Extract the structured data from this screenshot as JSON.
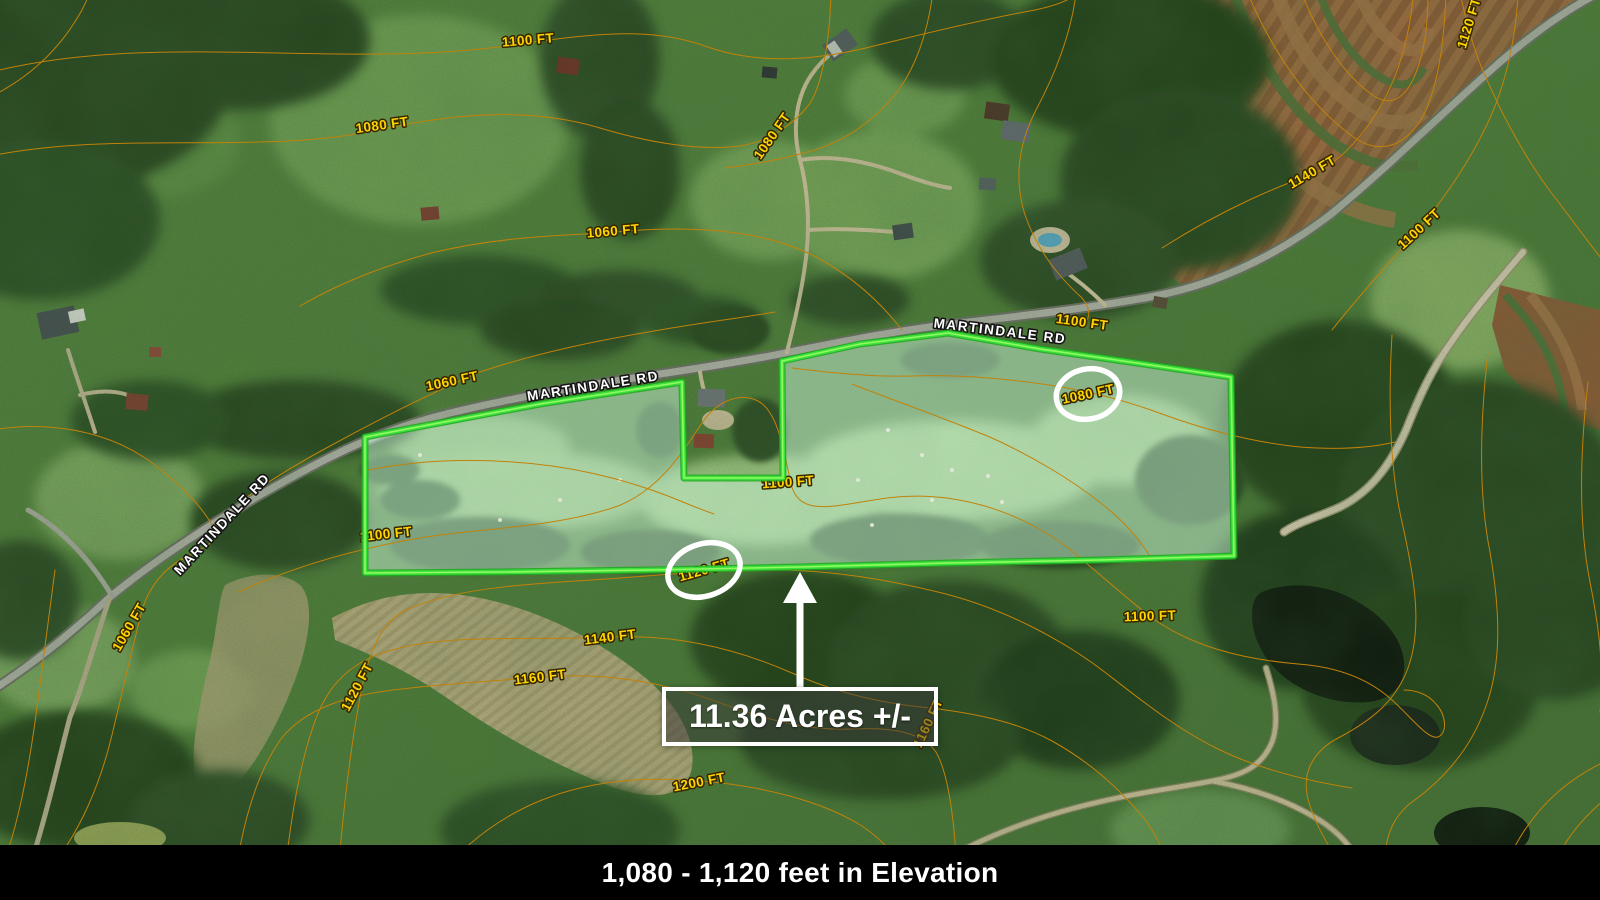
{
  "colors": {
    "contour_line": "#c28209",
    "contour_casing": "#7a4e00",
    "contour_label_fill": "#ffd400",
    "contour_label_outline": "#342700",
    "road_label_fill": "#ffffff",
    "road_label_outline": "#151515",
    "parcel_outline": "#3ae03a",
    "parcel_outline_glow": "#a9ff6e",
    "parcel_fill": "rgba(202,243,216,0.5)",
    "highlight_ellipse": "#ffffff",
    "arrow": "#ffffff",
    "callout_border": "#ffffff",
    "callout_bg": "rgba(58,58,58,0.52)",
    "callout_text": "#ffffff",
    "footer_bg": "#000000",
    "footer_text": "#ffffff"
  },
  "annotations": {
    "acreage_callout": {
      "text": "11.36 Acres +/-"
    },
    "footer": {
      "text": "1,080 - 1,120 feet in Elevation"
    },
    "road_labels": [
      {
        "text": "MARTINDALE RD",
        "x": 593,
        "y": 386,
        "rotation": -9
      },
      {
        "text": "MARTINDALE RD",
        "x": 1000,
        "y": 331,
        "rotation": 7
      },
      {
        "text": "MARTINDALE RD",
        "x": 222,
        "y": 524,
        "rotation": -47
      }
    ],
    "contour_labels": [
      {
        "text": "1100 FT",
        "x": 528,
        "y": 40,
        "rotation": -5
      },
      {
        "text": "1080 FT",
        "x": 382,
        "y": 125,
        "rotation": -8
      },
      {
        "text": "1080 FT",
        "x": 772,
        "y": 136,
        "rotation": -55
      },
      {
        "text": "1060 FT",
        "x": 613,
        "y": 231,
        "rotation": -5
      },
      {
        "text": "1060 FT",
        "x": 452,
        "y": 381,
        "rotation": -12
      },
      {
        "text": "1100 FT",
        "x": 1082,
        "y": 322,
        "rotation": 8
      },
      {
        "text": "1080 FT",
        "x": 1088,
        "y": 394,
        "rotation": -12,
        "circled": true
      },
      {
        "text": "1100 FT",
        "x": 788,
        "y": 482,
        "rotation": -4
      },
      {
        "text": "1100 FT",
        "x": 386,
        "y": 534,
        "rotation": -6
      },
      {
        "text": "1120 FT",
        "x": 704,
        "y": 570,
        "rotation": -16,
        "circled": true
      },
      {
        "text": "1140 FT",
        "x": 610,
        "y": 637,
        "rotation": -7
      },
      {
        "text": "1160 FT",
        "x": 540,
        "y": 677,
        "rotation": -7
      },
      {
        "text": "1120 FT",
        "x": 357,
        "y": 687,
        "rotation": -62
      },
      {
        "text": "1060 FT",
        "x": 129,
        "y": 627,
        "rotation": -60
      },
      {
        "text": "1200 FT",
        "x": 699,
        "y": 782,
        "rotation": -11
      },
      {
        "text": "1160 FT",
        "x": 928,
        "y": 723,
        "rotation": -65
      },
      {
        "text": "1100 FT",
        "x": 1150,
        "y": 616,
        "rotation": -2
      },
      {
        "text": "1140 FT",
        "x": 1312,
        "y": 172,
        "rotation": -30
      },
      {
        "text": "1100 FT",
        "x": 1419,
        "y": 229,
        "rotation": -43
      },
      {
        "text": "1120 FT",
        "x": 1469,
        "y": 23,
        "rotation": -73
      }
    ],
    "highlight_ellipses": [
      {
        "cx": 1088,
        "cy": 394,
        "rx": 32,
        "ry": 25,
        "rotation": -12
      },
      {
        "cx": 704,
        "cy": 570,
        "rx": 37,
        "ry": 26,
        "rotation": -18
      }
    ]
  }
}
